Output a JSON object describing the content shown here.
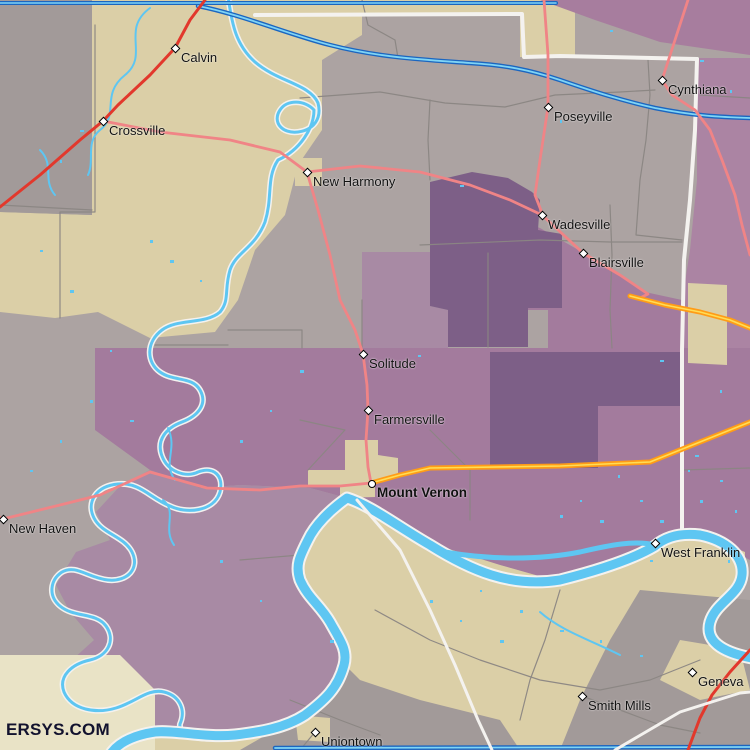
{
  "watermark": "ERSYS.COM",
  "palette": {
    "base": "#aca3a2",
    "grayPatch": "#a29a99",
    "tan": "#dbcfa7",
    "tanLight": "#e9e3c6",
    "purpleDark": "#7d5f87",
    "purpleMed": "#a37b9d",
    "purpleMed2": "#a88aa4",
    "purpleLight": "#ab84a3",
    "purpleTopRight": "#a77d9e",
    "waterLight": "#5ec6f2",
    "waterCore": "#7fd4f5",
    "waterCasing": "#1b66c0",
    "whiteBoundary": "#f4f2ef",
    "grayLine": "#8b8683",
    "roadRed": "#e2382c",
    "roadPink": "#f08486",
    "roadOrange": "#ff9c17",
    "roadYellow": "#ffdd55",
    "labelColor": "#111111",
    "watermark": "#12122e"
  },
  "towns": [
    {
      "name": "Calvin",
      "x": 175,
      "y": 48,
      "marker": "diamond",
      "bold": false
    },
    {
      "name": "Crossville",
      "x": 103,
      "y": 121,
      "marker": "diamond",
      "bold": false
    },
    {
      "name": "New Harmony",
      "x": 307,
      "y": 172,
      "marker": "diamond",
      "bold": false
    },
    {
      "name": "Poseyville",
      "x": 548,
      "y": 107,
      "marker": "diamond",
      "bold": false
    },
    {
      "name": "Cynthiana",
      "x": 662,
      "y": 80,
      "marker": "diamond",
      "bold": false
    },
    {
      "name": "Wadesville",
      "x": 542,
      "y": 215,
      "marker": "diamond",
      "bold": false
    },
    {
      "name": "Blairsville",
      "x": 583,
      "y": 253,
      "marker": "diamond",
      "bold": false
    },
    {
      "name": "Solitude",
      "x": 363,
      "y": 354,
      "marker": "diamond",
      "bold": false
    },
    {
      "name": "Farmersville",
      "x": 368,
      "y": 410,
      "marker": "diamond",
      "bold": false
    },
    {
      "name": "Mount Vernon",
      "x": 371,
      "y": 483,
      "marker": "circle",
      "bold": true
    },
    {
      "name": "New Haven",
      "x": 3,
      "y": 519,
      "marker": "diamond",
      "bold": false
    },
    {
      "name": "West Franklin",
      "x": 655,
      "y": 543,
      "marker": "diamond",
      "bold": false
    },
    {
      "name": "Smith Mills",
      "x": 582,
      "y": 696,
      "marker": "diamond",
      "bold": false
    },
    {
      "name": "Geneva",
      "x": 692,
      "y": 672,
      "marker": "diamond",
      "bold": false
    },
    {
      "name": "Uniontown",
      "x": 315,
      "y": 732,
      "marker": "diamond",
      "bold": false
    }
  ]
}
